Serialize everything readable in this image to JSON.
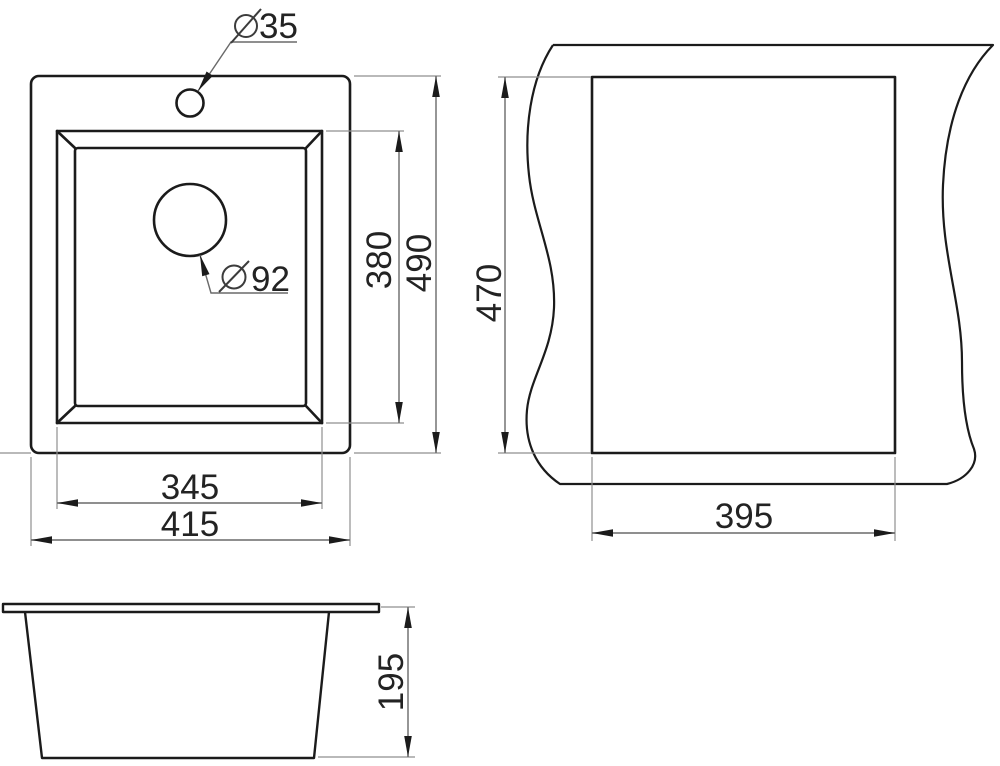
{
  "drawing_type": "sink technical drawing",
  "views": {
    "top_view": {
      "faucet_hole": {
        "symbol": "⌀",
        "value": "35"
      },
      "drain_hole": {
        "symbol": "⌀",
        "value": "92"
      },
      "bowl_width": "345",
      "overall_width": "415",
      "bowl_length": "380",
      "overall_length": "490"
    },
    "cutout_view": {
      "cutout_height": "470",
      "cutout_width": "395"
    },
    "side_view": {
      "bowl_depth": "195"
    }
  },
  "colors": {
    "background": "#ffffff",
    "object_line": "#1b1b1b",
    "dimension_line": "#6a6a6a",
    "extension_line": "#8f8f8f",
    "arrowhead": "#1b1b1b",
    "text": "#232323"
  }
}
